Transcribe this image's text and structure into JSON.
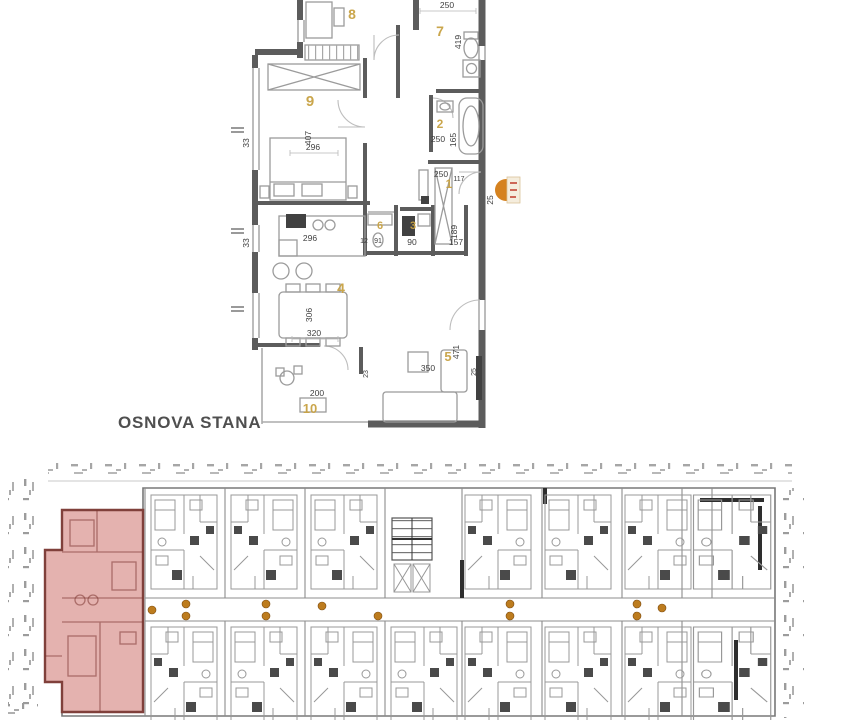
{
  "title": "OSNOVA STANA",
  "colors": {
    "paper": "#ffffff",
    "wall": "#5c5c5c",
    "wall_light": "#ababab",
    "furniture": "#9b9b9b",
    "fixture_dark": "#414141",
    "room_number": "#c8a243",
    "dim_text": "#3e3e3e",
    "tick": "#9c9c9c",
    "outline": "#787878",
    "highlight_fill": "rgba(198,95,88,0.48)",
    "highlight_stroke": "#80403b",
    "highlight_inner": "rgba(124,52,47,0.55)",
    "door_marker": "#bd7c1e",
    "compass_orange": "#d5821f",
    "compass_red": "#c03b2a",
    "title_color": "#4f4f4f"
  },
  "apartment_plan": {
    "room_numbers": {
      "r1": "1",
      "r2": "2",
      "r3": "3",
      "r4": "4",
      "r5": "5",
      "r6": "6",
      "r7": "7",
      "r8": "8",
      "r9": "9",
      "r10": "10"
    },
    "dimensions": {
      "room7_width": "250",
      "room7_height": "419",
      "room9_height": "407",
      "room9_width": "296",
      "wall_left_upper": "33",
      "bath_width": "250",
      "bath_height": "165",
      "entry_width": "250",
      "entry_height": "117",
      "right_wall": "25",
      "wc_width_a": "12",
      "wc_width_b": "91",
      "room3_width": "90",
      "room3_height": "189",
      "hall_width": "157",
      "kitchen_width": "296",
      "wall_left_lower": "33",
      "dining_height": "306",
      "dining_width": "320",
      "living_width": "350",
      "living_height": "471",
      "terrace_width": "200",
      "door_a": "23",
      "door_b": "25"
    }
  }
}
